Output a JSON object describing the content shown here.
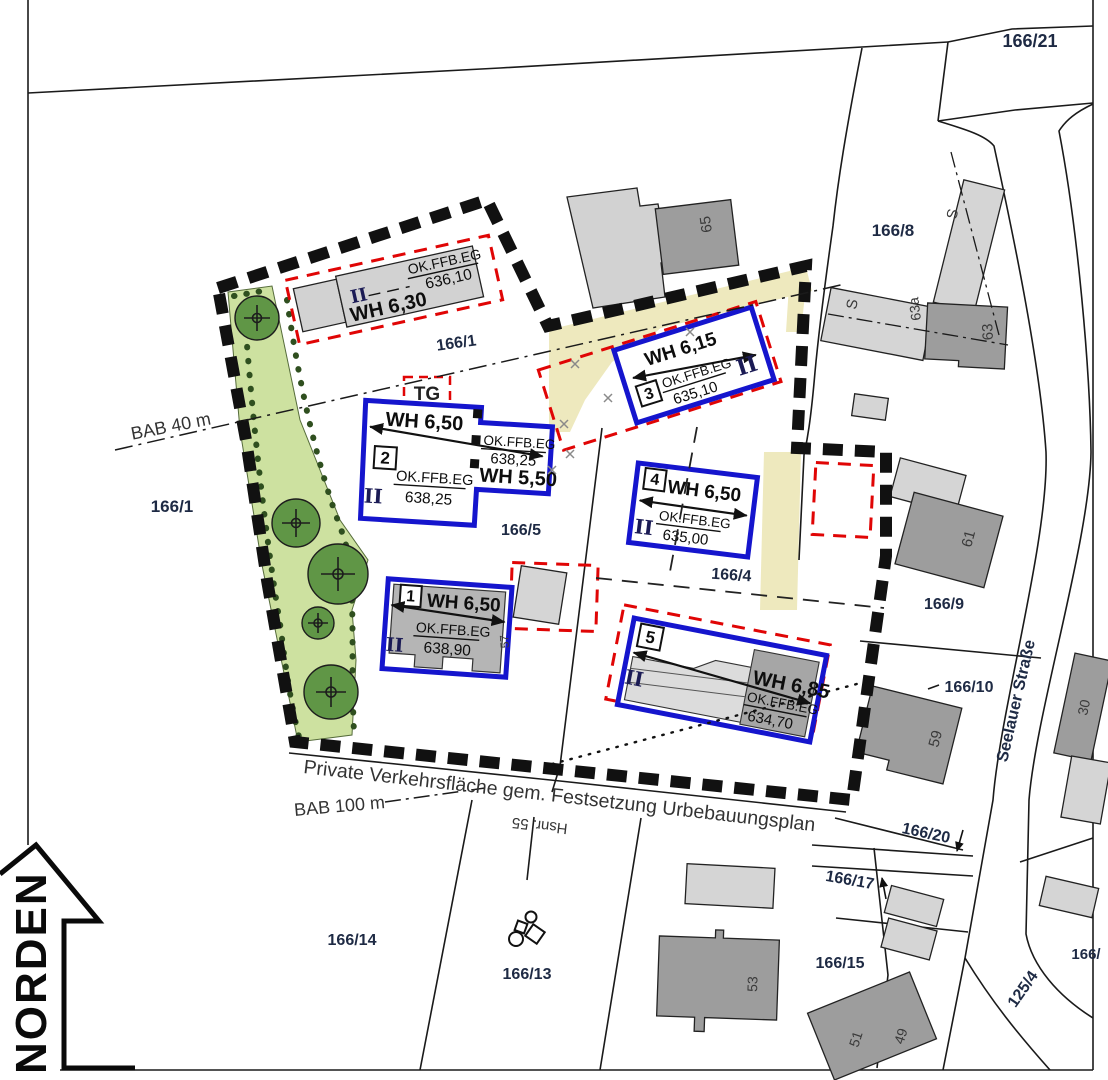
{
  "map": {
    "north_label": "NORDEN",
    "street": "Seelauer Straße",
    "notes": {
      "bab40": "BAB 40 m",
      "bab100": "BAB 100 m",
      "private_road": "Private Verkehrsfläche gem. Festsetzung Urbebauungsplan",
      "hsnr55": "Hsnr. 55",
      "tg": "TG"
    },
    "parcels": {
      "a166_21": "166/21",
      "a166_8": "166/8",
      "a166_1_outer": "166/1",
      "a166_1_inner": "166/1",
      "a166_5": "166/5",
      "a166_4": "166/4",
      "a166_9": "166/9",
      "a166_10": "166/10",
      "a166_20": "166/20",
      "a166_17": "166/17",
      "a166_15": "166/15",
      "a166_14": "166/14",
      "a166_13": "166/13",
      "a125_4": "125/4",
      "a166_cut": "166/"
    },
    "house_numbers": {
      "h65": "65",
      "h63": "63",
      "h63a": "63a",
      "h61": "61",
      "h59": "59",
      "h57": "57",
      "h53": "53",
      "h51": "51",
      "h49": "49",
      "h30": "30",
      "s_barn_upper": "S",
      "s_barn_lower": "S"
    },
    "buildings": {
      "b0": {
        "storeys": "II",
        "wall_height": "WH 6,30",
        "level_label": "OK.FFB.EG",
        "level_value": "636,10"
      },
      "b1": {
        "no": "1",
        "storeys": "II",
        "wall_height": "WH 6,50",
        "level_label": "OK.FFB.EG",
        "level_value": "638,90"
      },
      "b2": {
        "no": "2",
        "storeys": "II",
        "wall_height": "WH 6,50",
        "wall_height2": "WH 5,50",
        "level_label": "OK.FFB.EG",
        "level_value": "638,25",
        "level_label2": "OK.FFB.EG",
        "level_value2": "638,25"
      },
      "b3": {
        "no": "3",
        "storeys": "II",
        "wall_height": "WH 6,15",
        "level_label": "OK.FFB.EG",
        "level_value": "635,10"
      },
      "b4": {
        "no": "4",
        "storeys": "II",
        "wall_height": "WH 6,50",
        "level_label": "OK.FFB.EG",
        "level_value": "635,00"
      },
      "b5": {
        "no": "5",
        "storeys": "II",
        "wall_height": "WH 6,85",
        "level_label": "OK.FFB.EG",
        "level_value": "634,70"
      }
    },
    "colors": {
      "planned_outline": "#1515cd",
      "envelope_dashed": "#e00505",
      "boundary": "#111111",
      "green_area": "#cde1a0",
      "tree": "#609646",
      "yellow_strip": "#eee9be",
      "existing_light": "#d5d5d5",
      "existing_dark": "#9d9d9d"
    }
  }
}
